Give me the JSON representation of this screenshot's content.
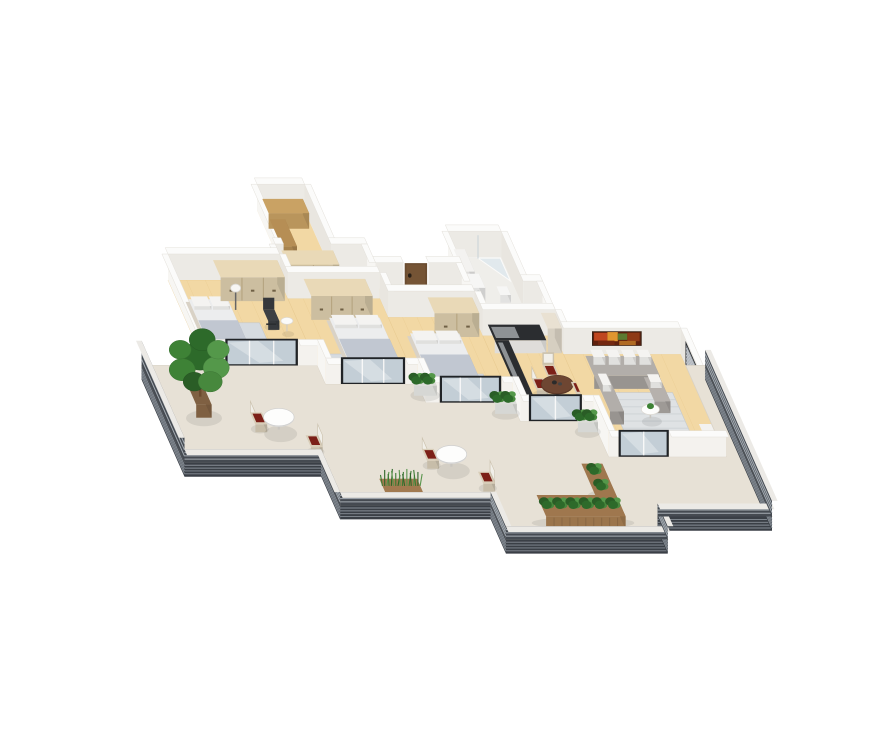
{
  "scene": {
    "proj": {
      "s": 30,
      "hs": 26,
      "x0": 168,
      "y0": 280,
      "ux": 0.93,
      "vx": 0.42,
      "vy": 0.95
    },
    "palette": {
      "wallTop": "#fbfbfa",
      "wallFaceEW": "#eceae5",
      "wallFaceNS": "#f7f6f3",
      "wallFaceInner": "#e9e6e0",
      "wallFaceFront": "#f4f2ee",
      "wood": "#f2d8a4",
      "woodShade": "#e8c98d",
      "tile": "#efeeea",
      "terrace": "#e7e1d6",
      "fascia": "#3a3f46",
      "fasciaLine": "#878e96",
      "rail": "#454a51",
      "railLine": "#a6adb4",
      "frame": "#202327",
      "glass": "#c3ced6",
      "door": "#6a4c30",
      "rug": "#d6dbe0",
      "rugLiving": "#dfe2e4",
      "sofa": "#a5a19d",
      "pillowWhite": "#f4f3f1",
      "bedBase": "#d9d2c6",
      "mattress": "#ecedee",
      "blanket": "#b6bcc5",
      "wardrobe": "#decfae",
      "wardrobeLine": "#b3a17c",
      "cabinet": "#f2f0ed",
      "counterTop": "#2b2d30",
      "tallCabinet": "#e9e1d2",
      "tableWood": "#6e4632",
      "tableWhite": "#fdfdfc",
      "chairBeige": "#d8cdb8",
      "cushionRed": "#7c2018",
      "officeChair": "#35373b",
      "planterWood": "#a97f53",
      "planterWhite": "#e9eae6",
      "potBrown": "#8a6848",
      "shelfWood": "#c9a264",
      "artBase": "#5f200c",
      "blindsBase": "#9aa0a6",
      "blindsLine": "#c6cad0",
      "greens": [
        "#2d6a2a",
        "#3e8236",
        "#54984a",
        "#2a5d26",
        "#47883d"
      ],
      "grassGreens": [
        "#3c7a33",
        "#2e6628",
        "#58944b"
      ],
      "shadow": "rgba(0,0,0,0.08)"
    },
    "backUnits": [
      {
        "name": "walk-in-closet",
        "rect": [
          4.3,
          -2.45,
          1.7,
          2.1
        ],
        "floor": "wood",
        "items": [
          {
            "type": "box",
            "name": "closet-shelving",
            "rect": [
              4.42,
              -2.3,
              1.45,
              0.5
            ],
            "h": 0.6,
            "c": "#c9a264"
          },
          {
            "type": "box",
            "name": "closet-shelving-2",
            "rect": [
              4.42,
              -1.72,
              0.55,
              0.95
            ],
            "h": 0.45,
            "c": "#b68e55"
          }
        ]
      },
      {
        "name": "bathroom",
        "rect": [
          10.4,
          -0.8,
          1.9,
          1.75
        ],
        "floor": "tile",
        "items": [
          {
            "type": "shower",
            "name": "shower-glass",
            "pts": [
              [
                11.45,
                -0.75
              ],
              [
                12.25,
                -0.75
              ],
              [
                12.25,
                0.05
              ]
            ]
          },
          {
            "type": "box",
            "name": "bathroom-vanity",
            "rect": [
              10.52,
              -0.62,
              0.4,
              0.78
            ],
            "h": 0.5,
            "c": "#f3f2f0"
          },
          {
            "type": "washer",
            "name": "washing-machine",
            "rect": [
              10.52,
              0.28,
              0.5,
              0.5
            ],
            "h": 0.55
          },
          {
            "type": "box",
            "name": "toilet",
            "rect": [
              11.55,
              0.5,
              0.38,
              0.3
            ],
            "h": 0.3,
            "c": "#f6f6f5"
          }
        ]
      }
    ],
    "corridors": [
      {
        "name": "hallway-1",
        "rect": [
          4.0,
          -0.35,
          3.3,
          1.0
        ]
      },
      {
        "name": "hallway-2",
        "rect": [
          7.3,
          0.3,
          3.1,
          1.0
        ]
      },
      {
        "name": "hallway-3",
        "rect": [
          10.4,
          0.95,
          2.6,
          1.0
        ]
      }
    ],
    "corridorItems": [
      {
        "type": "wardrobe",
        "name": "hall-wardrobe",
        "rect": [
          4.15,
          -0.2,
          1.85,
          0.5
        ]
      }
    ],
    "extraWalls": [
      {
        "a": [
          4.0,
          -0.35
        ],
        "b": [
          4.3,
          -0.35
        ],
        "dir": "ew"
      },
      {
        "a": [
          6.0,
          -0.35
        ],
        "b": [
          7.3,
          -0.35
        ],
        "dir": "ew"
      },
      {
        "a": [
          7.3,
          0.3
        ],
        "b": [
          8.3,
          0.3
        ],
        "dir": "ew"
      },
      {
        "a": [
          9.2,
          0.3
        ],
        "b": [
          10.4,
          0.3
        ],
        "dir": "ew"
      },
      {
        "a": [
          12.3,
          0.95
        ],
        "b": [
          13.0,
          0.95
        ],
        "dir": "ew"
      },
      {
        "a": [
          4.0,
          -0.35
        ],
        "b": [
          4.0,
          0.65
        ],
        "dir": "ns"
      },
      {
        "a": [
          7.3,
          -0.35
        ],
        "b": [
          7.3,
          0.3
        ],
        "dir": "ns"
      },
      {
        "a": [
          10.4,
          0.3
        ],
        "b": [
          10.4,
          0.95
        ],
        "dir": "ns"
      },
      {
        "a": [
          13.0,
          0.95
        ],
        "b": [
          13.0,
          1.95
        ],
        "dir": "ns"
      }
    ],
    "entryDoor": {
      "name": "entry-door",
      "v": 0.3,
      "from": 8.35,
      "to": 9.15
    },
    "rooms": [
      {
        "name": "bedroom-1",
        "rect": [
          0,
          0,
          4.0,
          3.0
        ],
        "door": [
          0.7,
          3.3
        ],
        "left": true,
        "furn": [
          {
            "type": "rug",
            "name": "rug",
            "rect": [
              0.5,
              1.5,
              2.1,
              1.3
            ]
          },
          {
            "type": "bed",
            "name": "bed",
            "rect": [
              0.2,
              0.95,
              1.55,
              1.9
            ]
          },
          {
            "type": "wardrobe",
            "name": "wardrobe",
            "rect": [
              1.55,
              0.14,
              2.3,
              0.6
            ]
          },
          {
            "type": "office-chair",
            "name": "desk-chair",
            "at": [
              2.8,
              1.35
            ]
          },
          {
            "type": "side-table",
            "name": "side-table",
            "at": [
              3.45,
              1.8
            ],
            "r": 0.2
          },
          {
            "type": "lamp",
            "name": "floor-lamp",
            "at": [
              1.95,
              1.05
            ]
          }
        ]
      },
      {
        "name": "bedroom-2",
        "rect": [
          4.0,
          0.65,
          3.3,
          3.0
        ],
        "door": [
          4.55,
          6.85
        ],
        "furn": [
          {
            "type": "wardrobe",
            "name": "wardrobe",
            "rect": [
              4.5,
              0.8,
              2.2,
              0.6
            ]
          },
          {
            "type": "rug",
            "name": "rug",
            "rect": [
              4.55,
              2.6,
              2.45,
              0.95
            ]
          },
          {
            "type": "bed",
            "name": "bed",
            "rect": [
              4.95,
              1.6,
              1.95,
              1.9
            ]
          }
        ]
      },
      {
        "name": "bedroom-3",
        "rect": [
          7.3,
          1.3,
          3.1,
          3.0
        ],
        "door": [
          7.8,
          10.0
        ],
        "furn": [
          {
            "type": "wardrobe",
            "name": "wardrobe",
            "rect": [
              8.65,
              1.45,
              1.6,
              0.55
            ]
          },
          {
            "type": "rug",
            "name": "rug",
            "rect": [
              7.7,
              3.3,
              2.1,
              0.9
            ]
          },
          {
            "type": "bed",
            "name": "bed",
            "rect": [
              7.6,
              2.15,
              1.9,
              1.9
            ]
          }
        ]
      },
      {
        "name": "kitchen-dining",
        "rect": [
          10.4,
          1.95,
          2.6,
          3.0
        ],
        "door": [
          10.7,
          12.6
        ],
        "furn": [
          {
            "type": "counter",
            "name": "kitchen-counter-back",
            "rect": [
              10.55,
              2.02,
              1.85,
              0.55
            ]
          },
          {
            "type": "counter",
            "name": "kitchen-counter-side",
            "rect": [
              10.55,
              2.57,
              0.5,
              1.9
            ]
          },
          {
            "type": "box",
            "name": "kitchen-tall-cabinet",
            "rect": [
              12.45,
              2.02,
              0.5,
              0.55
            ],
            "h": 0.95,
            "c": "#e9e1d2"
          },
          {
            "type": "chair",
            "name": "dining-chair-1",
            "at": [
              11.35,
              3.72
            ],
            "side": "w",
            "beige": true
          },
          {
            "type": "chair",
            "name": "dining-chair-2",
            "at": [
              11.95,
              3.25
            ],
            "side": "n",
            "beige": true
          },
          {
            "type": "round-table",
            "name": "dining-table",
            "at": [
              12.1,
              4.1
            ],
            "r": 0.52,
            "wood": true
          },
          {
            "type": "chair",
            "name": "dining-chair-3",
            "at": [
              12.7,
              3.85
            ],
            "side": "e",
            "beige": true
          },
          {
            "type": "chair",
            "name": "dining-chair-4",
            "at": [
              12.0,
              4.78
            ],
            "side": "s",
            "beige": true
          }
        ]
      },
      {
        "name": "living-room",
        "rect": [
          13.0,
          2.6,
          4.2,
          3.6
        ],
        "door": [
          13.35,
          15.15
        ],
        "furn": [
          {
            "type": "art",
            "name": "wall-artwork",
            "u0": 14.05,
            "u1": 15.75,
            "h0": 0.38,
            "h1": 0.88,
            "cells": [
              [
                0.02,
                0.3,
                0.35,
                0.95,
                "#bf4720"
              ],
              [
                0.3,
                0.52,
                0.3,
                1.0,
                "#e0962f"
              ],
              [
                0.52,
                0.72,
                0.4,
                0.9,
                "#5c7a30"
              ],
              [
                0.72,
                0.98,
                0.3,
                0.95,
                "#8e3a16"
              ],
              [
                0.1,
                0.45,
                0.0,
                0.35,
                "#73270f"
              ],
              [
                0.55,
                0.9,
                0.0,
                0.32,
                "#b06a22"
              ]
            ]
          },
          {
            "type": "blinds",
            "name": "window-blinds",
            "v0": 3.05,
            "v1": 4.3
          },
          {
            "type": "rug",
            "name": "living-rug",
            "rect": [
              13.95,
              3.95,
              2.35,
              1.5
            ],
            "living": true
          },
          {
            "type": "sofa",
            "name": "corner-sofa",
            "at": [
              13.55,
              3.12
            ]
          },
          {
            "type": "coffee-table",
            "name": "coffee-table",
            "at": [
              15.1,
              4.85
            ],
            "r": 0.3
          },
          {
            "type": "box",
            "name": "white-shelf",
            "rect": [
              16.5,
              5.6,
              0.6,
              0.45
            ],
            "h": 0.6,
            "c": "#f3f2f0"
          }
        ]
      }
    ],
    "terrace": {
      "outline": [
        [
          -2.3,
          3.0
        ],
        [
          0,
          3.0
        ],
        [
          4.0,
          3.0
        ],
        [
          4.0,
          3.65
        ],
        [
          7.3,
          3.65
        ],
        [
          7.3,
          4.3
        ],
        [
          10.4,
          4.3
        ],
        [
          10.4,
          4.95
        ],
        [
          13.0,
          4.95
        ],
        [
          13.0,
          6.2
        ],
        [
          17.2,
          6.2
        ],
        [
          17.2,
          3.0
        ],
        [
          17.9,
          3.0
        ],
        [
          17.9,
          8.3
        ],
        [
          13.8,
          8.3
        ],
        [
          13.8,
          9.1
        ],
        [
          8.0,
          9.1
        ],
        [
          8.0,
          7.9
        ],
        [
          2.6,
          7.9
        ],
        [
          2.6,
          6.4
        ],
        [
          -2.3,
          6.4
        ]
      ],
      "rails": [
        {
          "a": [
            -2.3,
            3.0
          ],
          "b": [
            -2.3,
            6.4
          ],
          "h": 0.95
        },
        {
          "a": [
            -2.3,
            6.4
          ],
          "b": [
            2.6,
            6.4
          ],
          "h": 0.5
        },
        {
          "a": [
            2.6,
            6.4
          ],
          "b": [
            2.6,
            7.9
          ],
          "h": 0.5
        },
        {
          "a": [
            2.6,
            7.9
          ],
          "b": [
            8.0,
            7.9
          ],
          "h": 0.5
        },
        {
          "a": [
            8.0,
            7.9
          ],
          "b": [
            8.0,
            9.1
          ],
          "h": 0.5
        },
        {
          "a": [
            8.0,
            9.1
          ],
          "b": [
            13.8,
            9.1
          ],
          "h": 0.5
        },
        {
          "a": [
            13.8,
            9.1
          ],
          "b": [
            13.8,
            8.3
          ],
          "h": 0.5
        },
        {
          "a": [
            13.8,
            8.3
          ],
          "b": [
            17.9,
            8.3
          ],
          "h": 0.5
        },
        {
          "a": [
            17.9,
            8.3
          ],
          "b": [
            17.9,
            3.0
          ],
          "h": 0.6
        }
      ],
      "furniture": [
        {
          "type": "tree",
          "name": "terrace-tree",
          "at": [
            -0.9,
            4.55
          ]
        },
        {
          "type": "planter",
          "name": "wall-planter-1",
          "rect": [
            6.98,
            3.74,
            0.82,
            0.32
          ],
          "white": true
        },
        {
          "type": "chair",
          "name": "terrace-chair-1",
          "at": [
            0.72,
            4.92
          ],
          "side": "w"
        },
        {
          "type": "round-table",
          "name": "terrace-table-1",
          "at": [
            1.6,
            5.25
          ],
          "r": 0.5
        },
        {
          "type": "chair",
          "name": "terrace-chair-2",
          "at": [
            2.35,
            5.72
          ],
          "side": "e"
        },
        {
          "type": "planter",
          "name": "wall-planter-2",
          "rect": [
            9.6,
            4.38,
            0.78,
            0.32
          ],
          "white": true
        },
        {
          "type": "planter",
          "name": "wall-planter-3",
          "rect": [
            12.28,
            5.02,
            0.72,
            0.32
          ],
          "white": true
        },
        {
          "type": "chair",
          "name": "terrace-chair-3",
          "at": [
            6.3,
            6.2
          ],
          "side": "w"
        },
        {
          "type": "round-table",
          "name": "terrace-table-2",
          "at": [
            7.2,
            6.55
          ],
          "r": 0.5
        },
        {
          "type": "chair",
          "name": "terrace-chair-4",
          "at": [
            7.95,
            7.0
          ],
          "side": "e"
        },
        {
          "type": "grass",
          "name": "grass-planter",
          "rect": [
            4.3,
            7.25,
            1.35,
            0.5
          ]
        },
        {
          "type": "planter",
          "name": "planter-L-short",
          "rect": [
            11.7,
            6.9,
            0.75,
            1.1
          ],
          "wood": true
        },
        {
          "type": "planter",
          "name": "planter-L-long",
          "rect": [
            9.6,
            8.0,
            2.85,
            0.75
          ],
          "wood": true
        }
      ]
    }
  }
}
